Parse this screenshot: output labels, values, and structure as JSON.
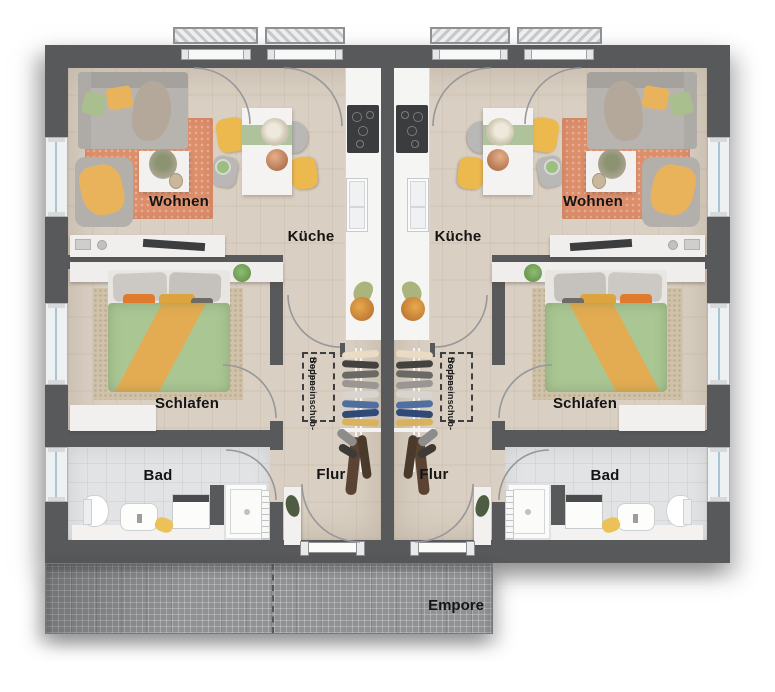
{
  "labels": {
    "living": "Wohnen",
    "kitchen": "Küche",
    "bedroom": "Schlafen",
    "bathroom": "Bad",
    "hallway": "Flur",
    "attic_stair_line1": "Bodeneinschub-",
    "attic_stair_line2": "treppe",
    "gallery": "Empore"
  },
  "colors": {
    "wall": "#58595b",
    "wood_floor": "#d9cfc2",
    "tile_floor": "#e1e3e5",
    "living_rug": "#dd8f6c",
    "bedroom_rug": "#cfc2a9",
    "duvet_green": "#a9c693",
    "blanket_orange": "#e3ac52",
    "chair_yellow": "#ecb94f",
    "sofa_gray": "#b7b4af",
    "runner_green": "#aec39c",
    "gallery_gray": "#8f9193",
    "window_glass": "#a9c4d6",
    "label_text": "#141414"
  }
}
